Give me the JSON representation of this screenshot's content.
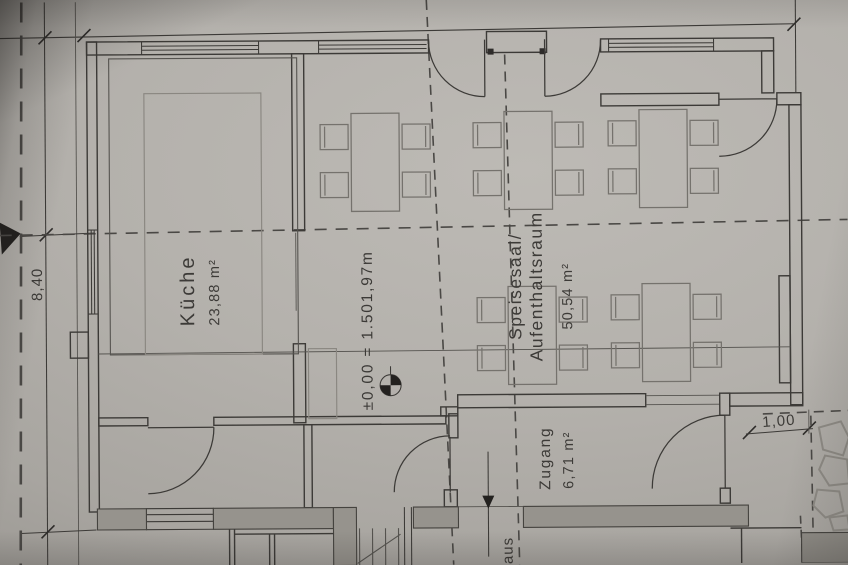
{
  "plan": {
    "rooms": [
      {
        "name": "Küche",
        "area": "23,88 m²"
      },
      {
        "name_line1": "Speisesaal/",
        "name_line2": "Aufenthaltsraum",
        "area": "50,54 m²"
      },
      {
        "name": "Zugang",
        "area": "6,71 m²"
      }
    ],
    "level_text": "±0,00 = 1.501,97m",
    "dim_left": "8,40",
    "dim_opening": "1,00",
    "partial_word": "aus",
    "furniture": {
      "table_w": 48,
      "table_h": 98,
      "chairs_per_table": 4,
      "tables": [
        {
          "x": 352,
          "y": 113
        },
        {
          "x": 505,
          "y": 112
        },
        {
          "x": 640,
          "y": 111
        },
        {
          "x": 508,
          "y": 287
        },
        {
          "x": 642,
          "y": 285
        }
      ]
    }
  },
  "colors": {
    "paper": "#b4b1ac",
    "ink": "#3c3a37",
    "furniture_ink": "#75726d",
    "wall_fill": "#96938d",
    "dash_line": "#4a4845"
  }
}
